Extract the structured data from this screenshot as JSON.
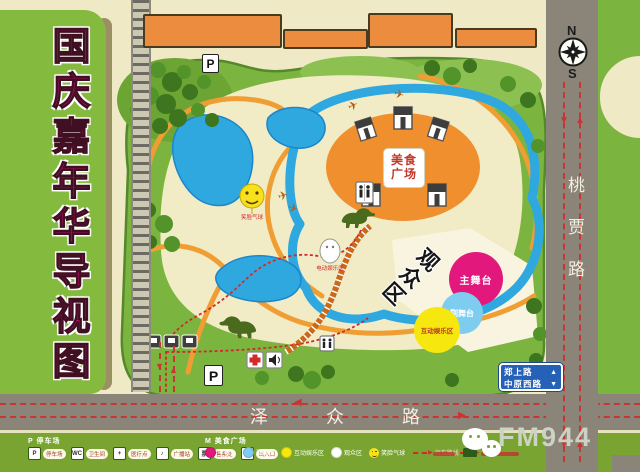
{
  "title": {
    "text": "国庆嘉年华导视图"
  },
  "compass": {
    "north": "N",
    "south": "S"
  },
  "roads": {
    "right": "桃贾路",
    "bottom": "泽众路"
  },
  "sign": {
    "line1": "郑上路",
    "arrow1": "▲",
    "line2": "中原西路",
    "arrow2": "▼"
  },
  "arrows": {
    "down": "▼",
    "up": "▲",
    "left": "◀",
    "right": "▶"
  },
  "map": {
    "food_plaza": "美食广场",
    "main_stage": "主舞台",
    "sub_stage": "副舞台",
    "interactive": "互动娱乐区",
    "audience": "观众区",
    "parking": "P",
    "balloon_label": "笑脸气球",
    "boat_label": "电动娱乐区"
  },
  "legend": {
    "left_header": "P 停车场",
    "items": [
      {
        "icon": "P",
        "label": "停车场"
      },
      {
        "icon": "WC",
        "label": "卫生间"
      },
      {
        "icon": "+",
        "label": "医疗点"
      },
      {
        "icon": "♪",
        "label": "广播站"
      },
      {
        "icon": "票",
        "label": "售票处"
      },
      {
        "icon": "门",
        "label": "出入口"
      }
    ],
    "right_header": "M 美食广场",
    "zones": [
      {
        "label": "主舞台",
        "color": "#e2187d"
      },
      {
        "label": "副舞台",
        "color": "#7ecdf0"
      },
      {
        "label": "互动娱乐区",
        "color": "#f6e70e"
      },
      {
        "label": "观众区",
        "color": "#ffffff"
      },
      {
        "label": "笑脸气球",
        "color": "#f6e11a"
      },
      {
        "label": "行车路线",
        "color": "#d22a2a"
      }
    ]
  },
  "footer": {
    "station": "FM944"
  },
  "colors": {
    "background": "#efe9c6",
    "park_green": "#7cb440",
    "panel_green": "#84ba3e",
    "road_gray": "#8b8478",
    "lake_blue": "#2fa8df",
    "path_orange": "#f09d33",
    "plaza_orange": "#ef8f2d",
    "title_magenta": "#e40980",
    "route_red": "#c93434",
    "sign_blue": "#2661b8"
  }
}
